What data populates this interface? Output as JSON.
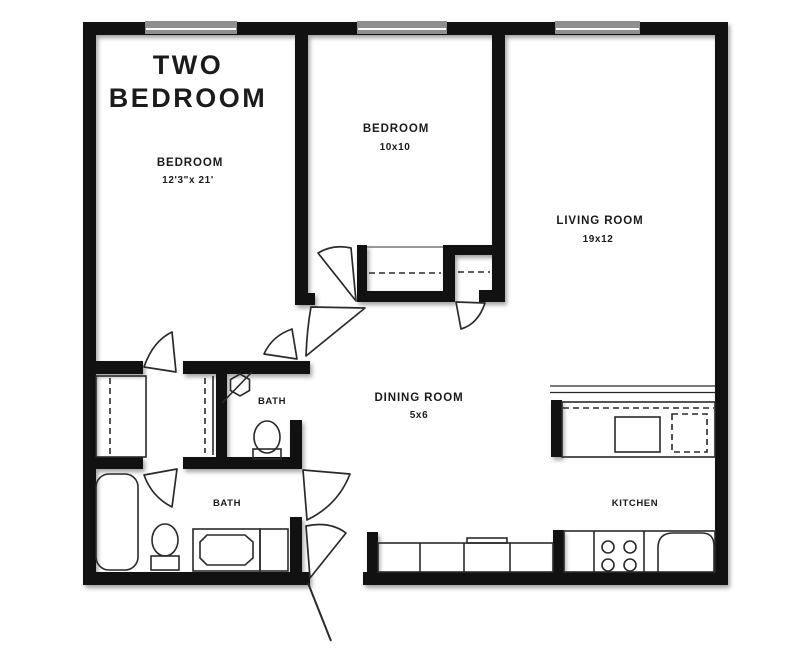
{
  "title": {
    "line1": "TWO",
    "line2": "BEDROOM"
  },
  "rooms": {
    "bedroom1": {
      "name": "BEDROOM",
      "dims": "12'3\"x 21'"
    },
    "bedroom2": {
      "name": "BEDROOM",
      "dims": "10x10"
    },
    "living": {
      "name": "LIVING ROOM",
      "dims": "19x12"
    },
    "dining": {
      "name": "DINING ROOM",
      "dims": "5x6"
    },
    "bath_upper": {
      "name": "BATH"
    },
    "bath_lower": {
      "name": "BATH"
    },
    "kitchen": {
      "name": "KITCHEN"
    }
  },
  "fixtures": [
    "shower-stall",
    "toilet",
    "toilet",
    "bathtub",
    "vanity-sink",
    "kitchen-sink",
    "stove-burners",
    "dishwasher",
    "counter",
    "closet-rod",
    "window",
    "door-swing"
  ],
  "colors": {
    "wall": "#111111",
    "window": "#8f8f8f",
    "line": "#2a2a2a",
    "text": "#1b1b1b",
    "background": "#ffffff"
  }
}
